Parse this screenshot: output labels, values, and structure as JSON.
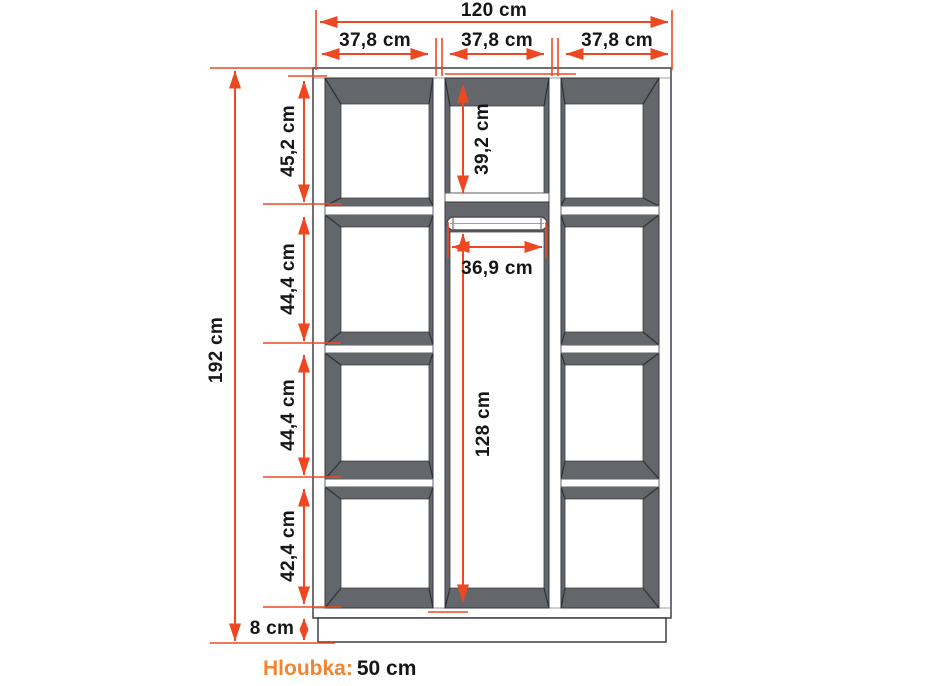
{
  "dimensions": {
    "total_width": "120 cm",
    "sections_top": [
      "37,8 cm",
      "37,8 cm",
      "37,8 cm"
    ],
    "total_height": "192 cm",
    "left_column": [
      "45,2 cm",
      "44,4 cm",
      "44,4 cm",
      "42,4 cm"
    ],
    "plinth": "8 cm",
    "center_top": "39,2 cm",
    "hanging_width": "36,9 cm",
    "hanging_height": "128 cm"
  },
  "footer": {
    "depth_label": "Hloubka:",
    "depth_value": "50 cm"
  },
  "colors": {
    "dimension_red": "#EE4823",
    "accent_orange": "#F08532",
    "cabinet_gray": "#63666B",
    "background": "#FFFFFF"
  }
}
